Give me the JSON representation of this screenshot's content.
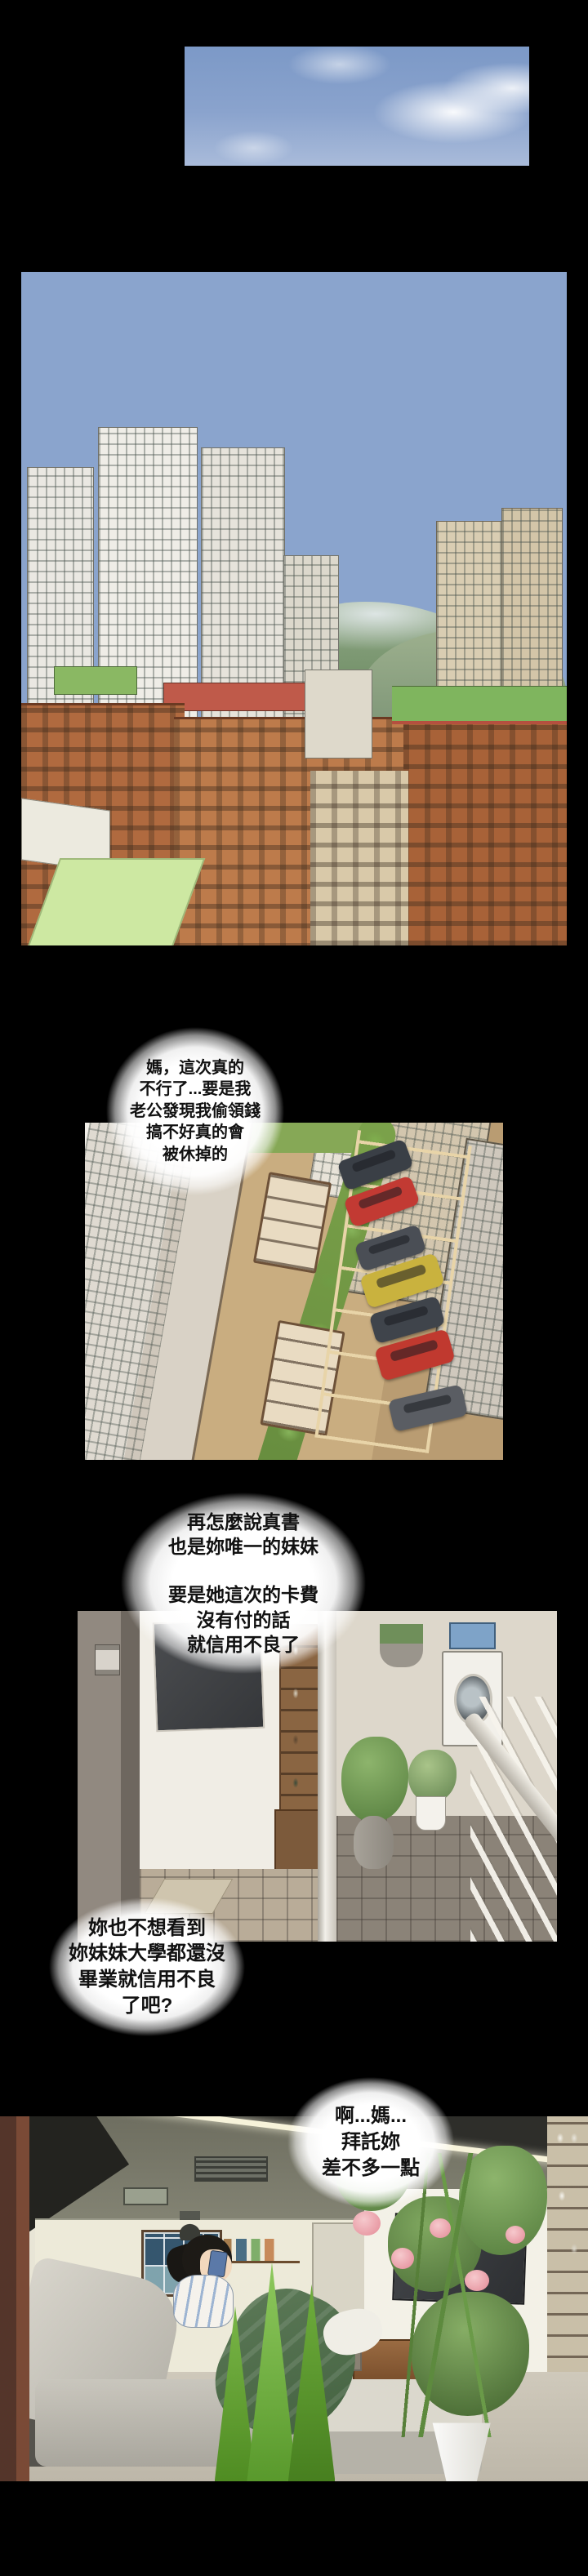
{
  "page": {
    "kind": "webtoon-comic-page",
    "background": "#000000"
  },
  "colors": {
    "page_bg": "#000000",
    "bubble_fill": "#ffffff",
    "bubble_text": "#111111",
    "sky_blue": "#7b98c6",
    "ground_tan": "#b99c72",
    "brick_red": "#b06a3f",
    "roof_green": "#7fb55e",
    "car_red": "#c23a33",
    "car_yellow": "#c9b23e",
    "plant_green": "#6f9c45",
    "flower_pink": "#eeaab2"
  },
  "bubbles": {
    "b1": {
      "lines": [
        "媽，這次真的",
        "不行了...要是我",
        "老公發現我偷領錢",
        "搞不好真的會",
        "被休掉的"
      ]
    },
    "b2": {
      "lines": [
        "再怎麼說真書",
        "也是妳唯一的妹妹",
        "",
        "要是她這次的卡費",
        "沒有付的話",
        "就信用不良了"
      ]
    },
    "b3": {
      "lines": [
        "妳也不想看到",
        "妳妹妹大學都還沒",
        "畢業就信用不良",
        "了吧?"
      ]
    },
    "b4": {
      "lines": [
        "啊...媽...",
        "拜託妳",
        "差不多一點"
      ]
    }
  }
}
